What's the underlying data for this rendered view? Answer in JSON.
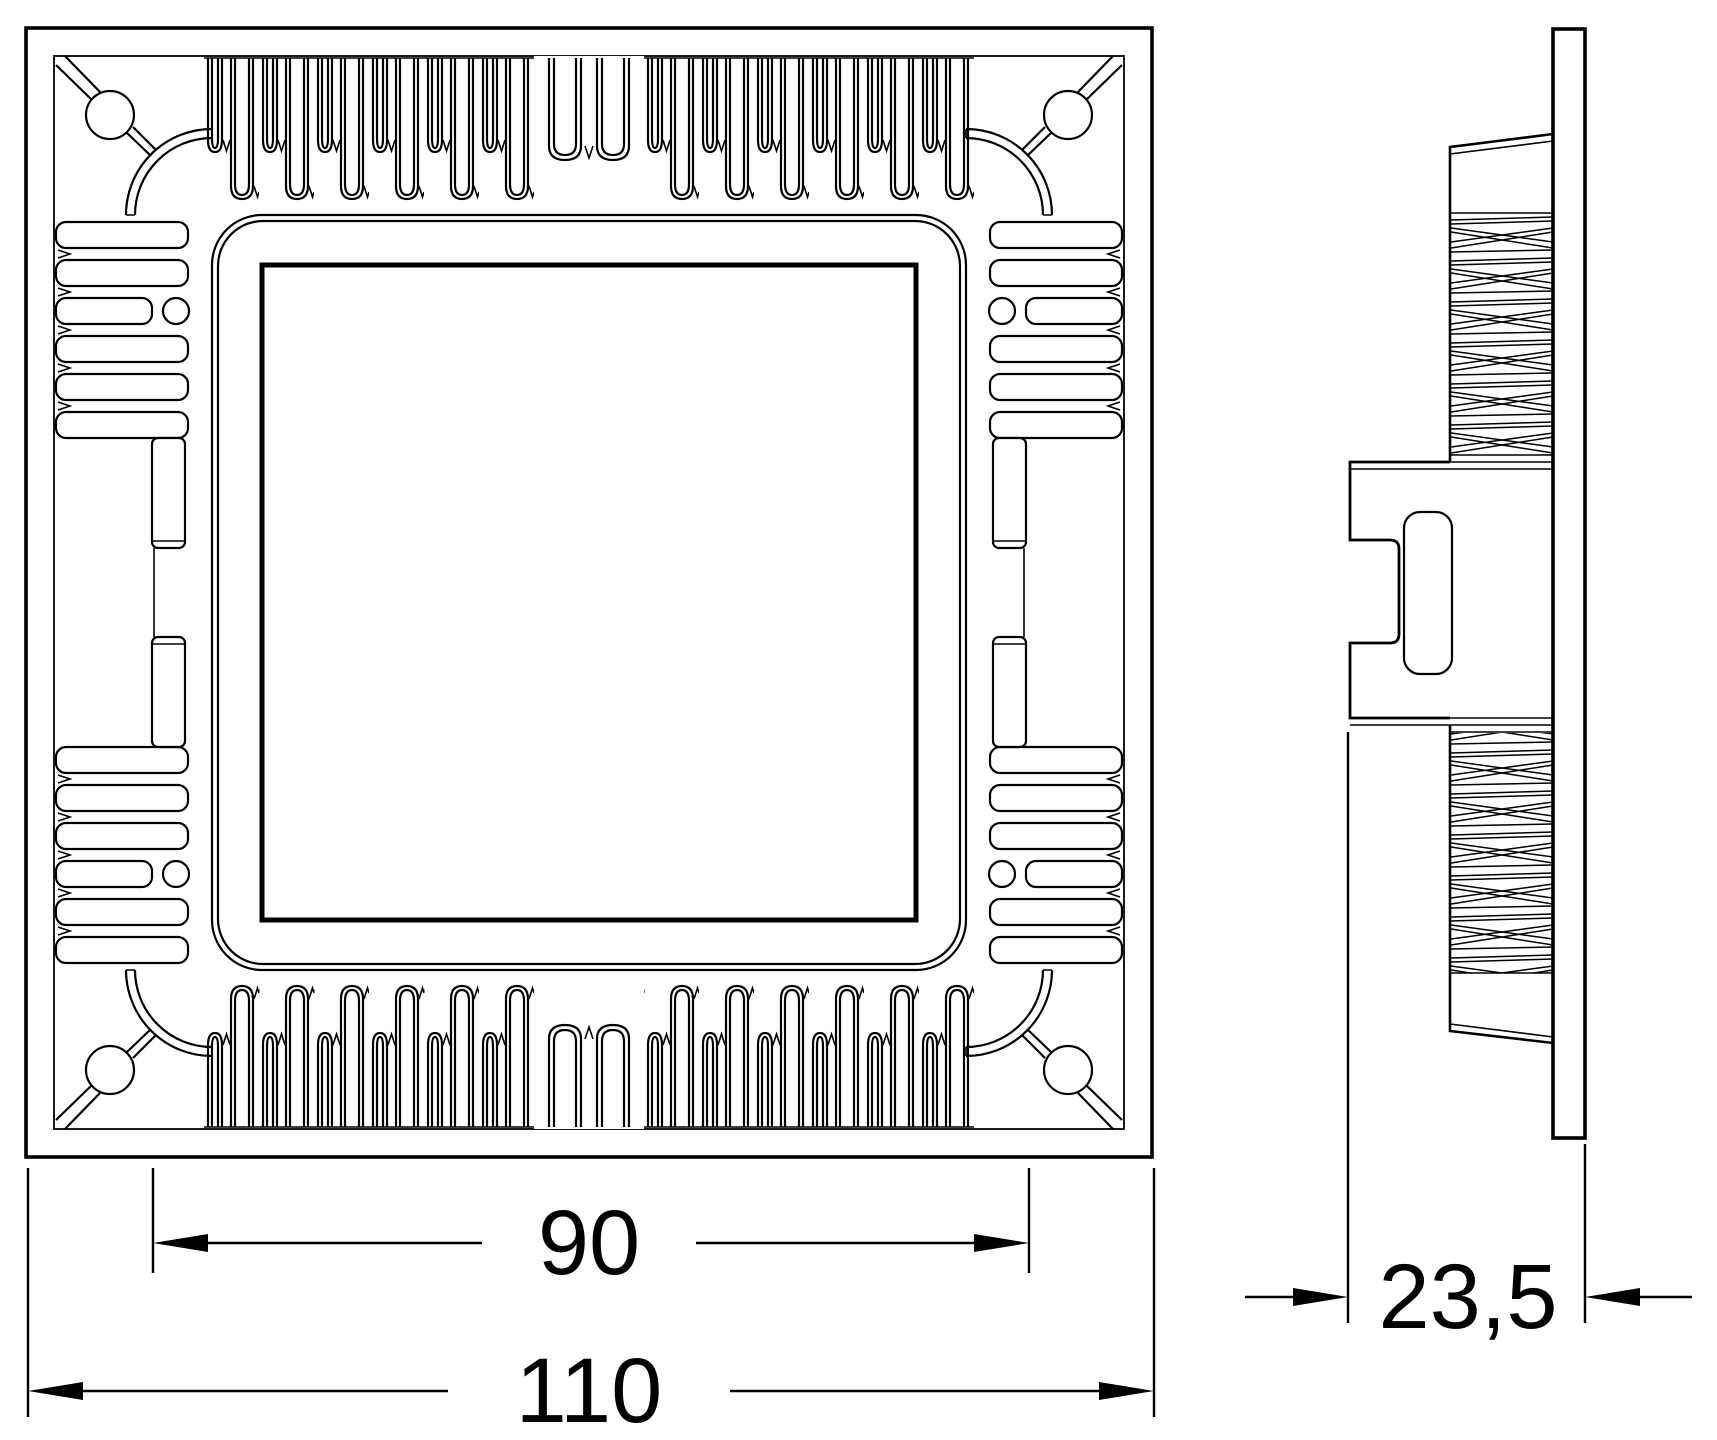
{
  "drawing": {
    "title": "square-downlight-heatsink-technical-drawing",
    "colors": {
      "line": "#000000",
      "background": "#ffffff"
    },
    "views": {
      "front": {
        "name": "front-view"
      },
      "side": {
        "name": "side-view"
      }
    },
    "dimensions": {
      "fin_span": {
        "value": "90"
      },
      "overall_width": {
        "value": "110"
      },
      "overall_depth": {
        "value": "23,5"
      }
    }
  }
}
